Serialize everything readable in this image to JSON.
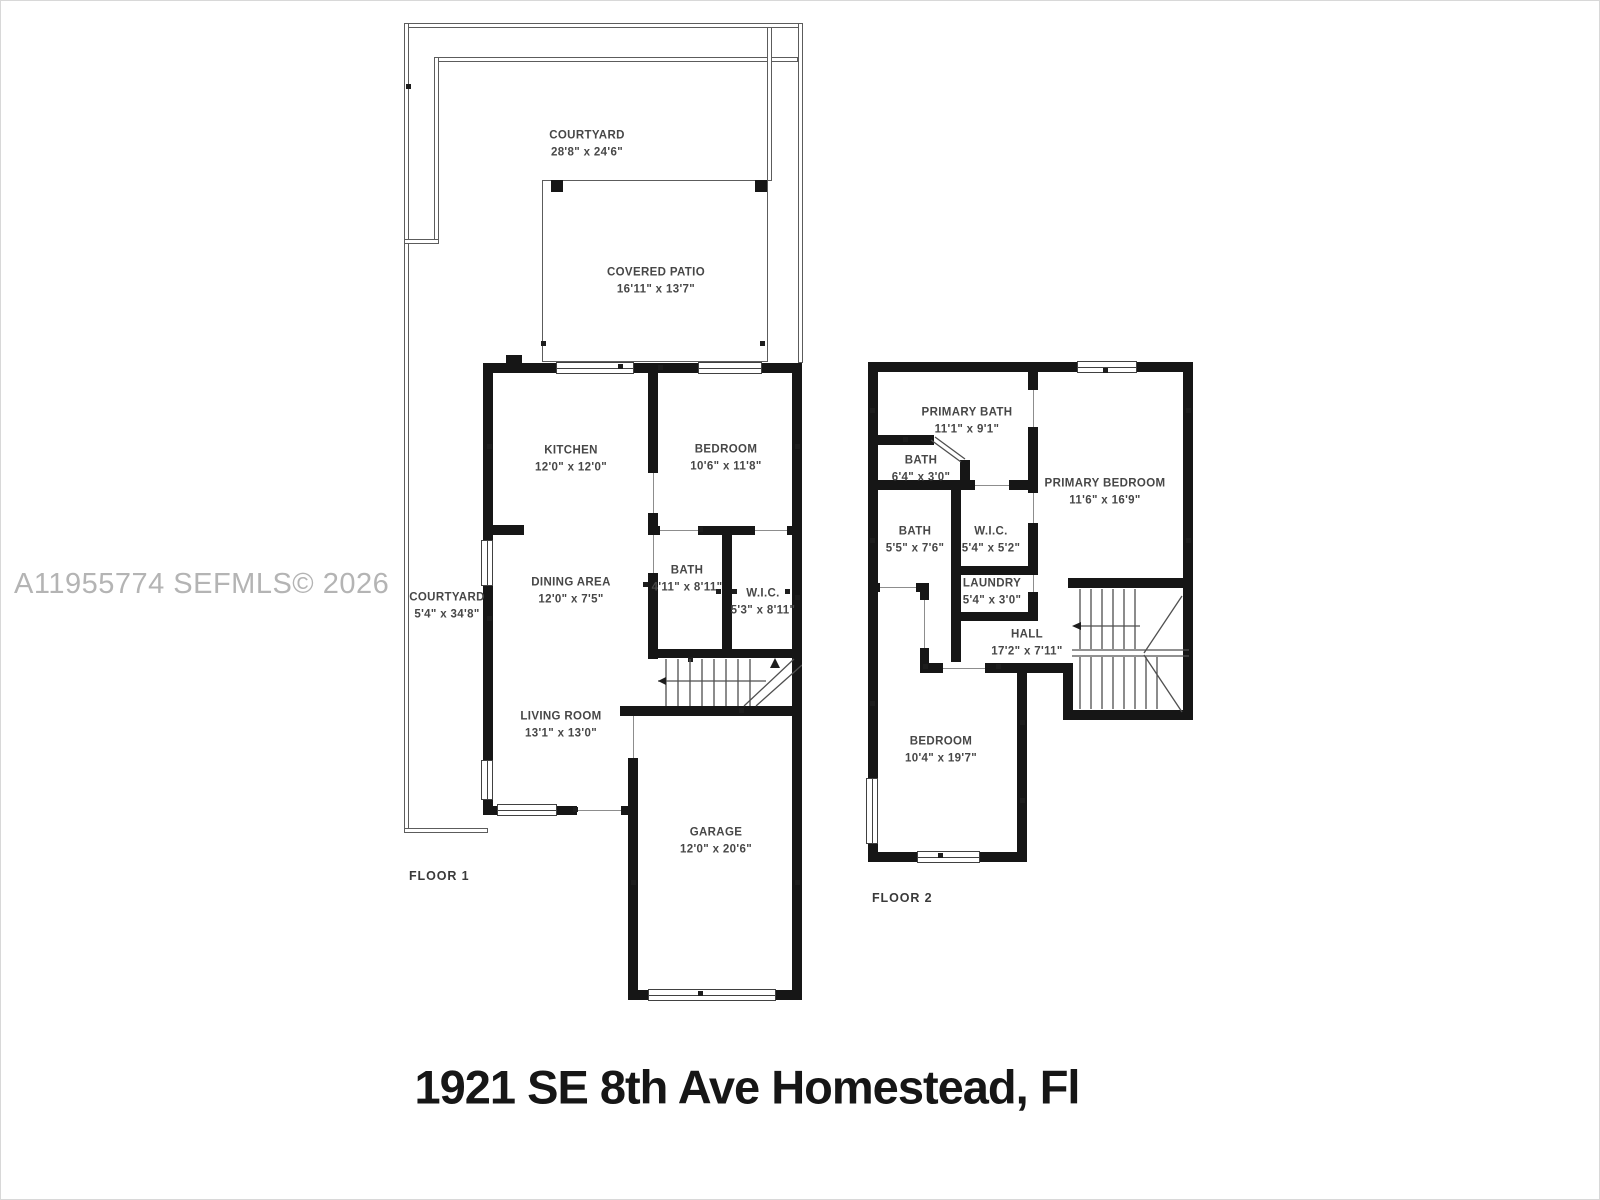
{
  "title": "1921 SE 8th Ave Homestead, Fl",
  "watermark": "A11955774  SEFMLS© 2026",
  "colors": {
    "wall": "#161616",
    "label": "#474747",
    "watermark": "#b4b4b4",
    "thin_line": "#5c5c5c"
  },
  "floor1": {
    "label": "FLOOR 1",
    "rooms": [
      {
        "name": "COURTYARD",
        "dims": "28'8\" x 24'6\""
      },
      {
        "name": "COVERED PATIO",
        "dims": "16'11\" x 13'7\""
      },
      {
        "name": "KITCHEN",
        "dims": "12'0\" x 12'0\""
      },
      {
        "name": "BEDROOM",
        "dims": "10'6\" x 11'8\""
      },
      {
        "name": "COURTYARD",
        "dims": "5'4\" x 34'8\""
      },
      {
        "name": "DINING AREA",
        "dims": "12'0\" x 7'5\""
      },
      {
        "name": "BATH",
        "dims": "4'11\" x 8'11\""
      },
      {
        "name": "W.I.C.",
        "dims": "5'3\" x 8'11\""
      },
      {
        "name": "LIVING ROOM",
        "dims": "13'1\" x 13'0\""
      },
      {
        "name": "GARAGE",
        "dims": "12'0\" x 20'6\""
      }
    ]
  },
  "floor2": {
    "label": "FLOOR 2",
    "rooms": [
      {
        "name": "PRIMARY BATH",
        "dims": "11'1\" x 9'1\""
      },
      {
        "name": "BATH",
        "dims": "6'4\" x 3'0\""
      },
      {
        "name": "PRIMARY BEDROOM",
        "dims": "11'6\" x 16'9\""
      },
      {
        "name": "BATH",
        "dims": "5'5\" x 7'6\""
      },
      {
        "name": "W.I.C.",
        "dims": "5'4\" x 5'2\""
      },
      {
        "name": "LAUNDRY",
        "dims": "5'4\" x 3'0\""
      },
      {
        "name": "HALL",
        "dims": "17'2\" x 7'11\""
      },
      {
        "name": "BEDROOM",
        "dims": "10'4\" x 19'7\""
      }
    ]
  }
}
